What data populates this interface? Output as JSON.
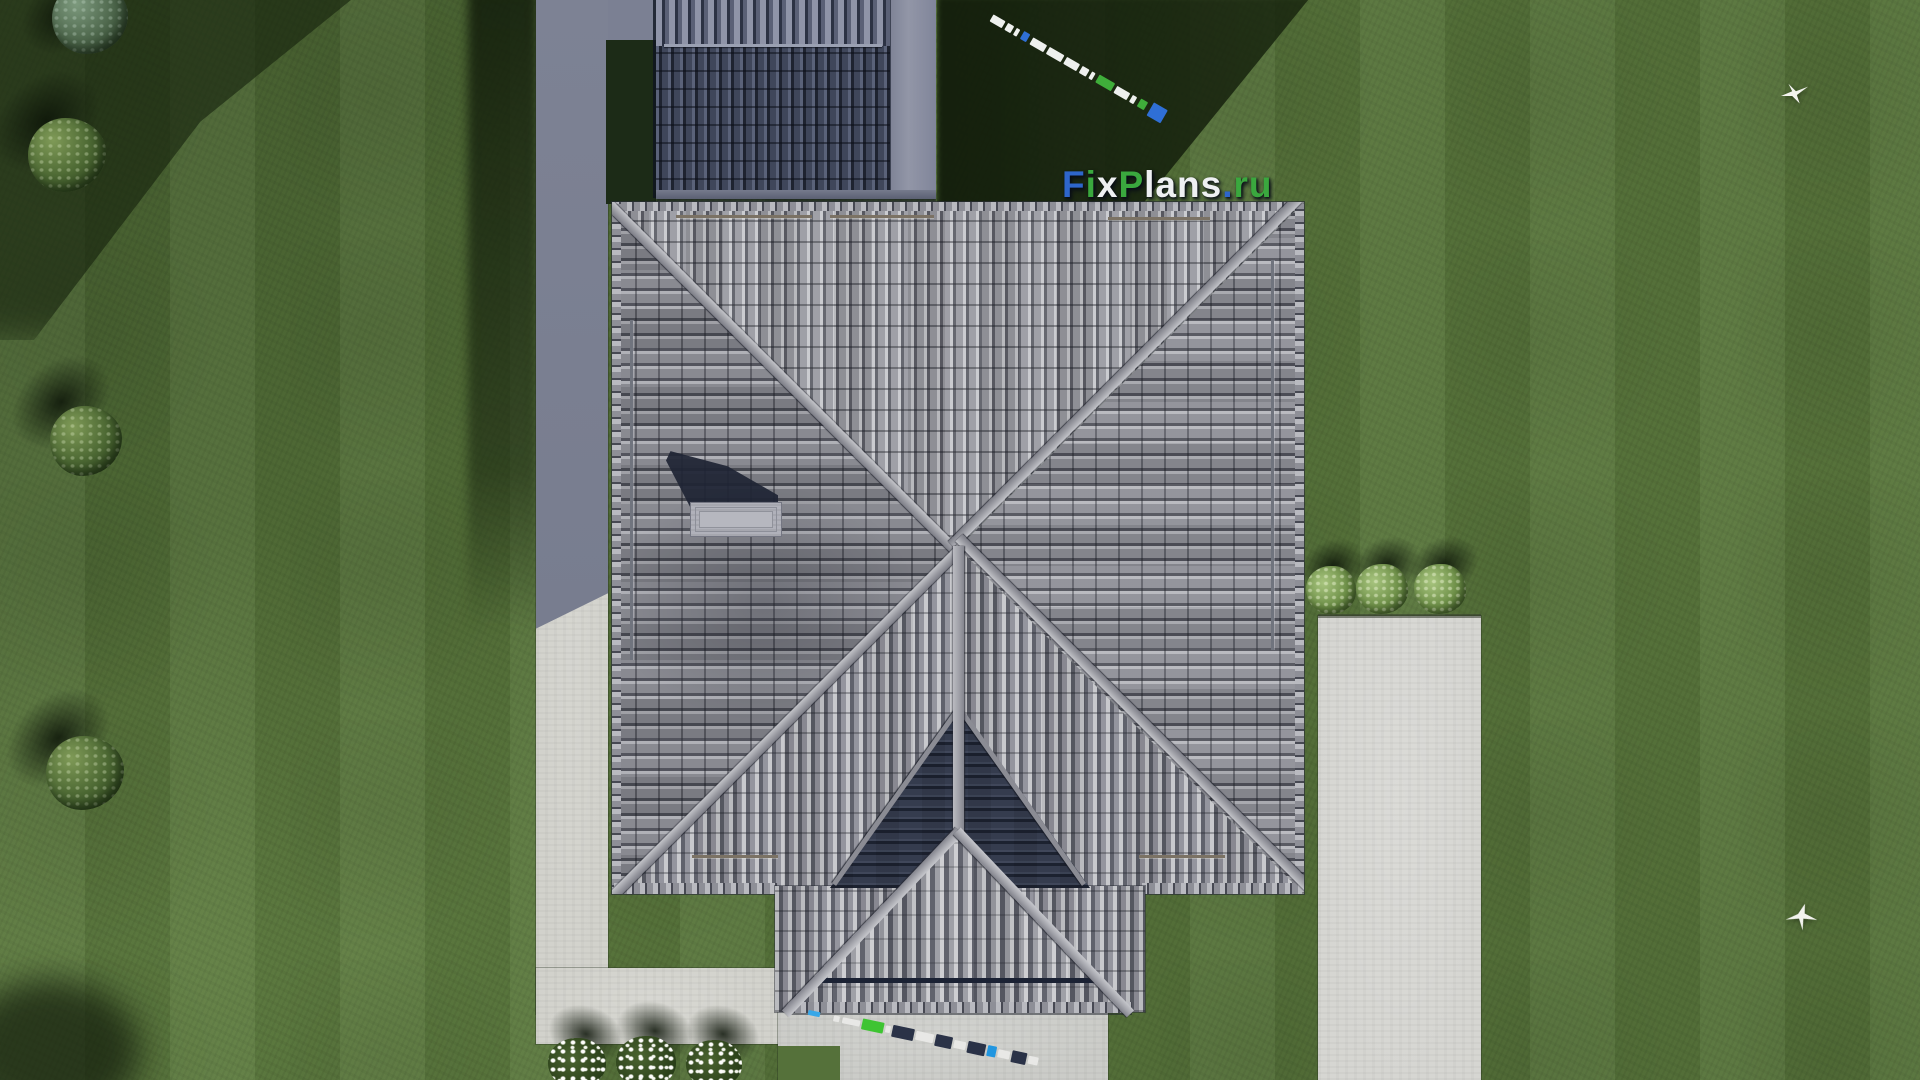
{
  "watermark": {
    "text": "FixPlans.ru",
    "segments": [
      {
        "text": "F",
        "color": "#2e66cb"
      },
      {
        "text": "i",
        "color": "#3aa83e"
      },
      {
        "text": "x",
        "color": "#eef0f2"
      },
      {
        "text": "P",
        "color": "#3aa83e"
      },
      {
        "text": "lans",
        "color": "#eef0f2"
      },
      {
        "text": ".",
        "color": "#2e66cb"
      },
      {
        "text": "ru",
        "color": "#3aa83e"
      }
    ]
  },
  "colors": {
    "grass_base": "#57743b",
    "grass_shadow": "#1c2b17",
    "concrete_light": "#d2d2cc",
    "concrete_shadow": "#7b8093",
    "roof_light_face": "#9a9ba2",
    "roof_dark_gap": "#53555f",
    "roof_ridge": "#a8a9b0",
    "annex_tile": "#3a4154",
    "pediment": "#353c4e",
    "watermark_blue": "#2e66cb",
    "watermark_green": "#3aa83e",
    "watermark_white": "#eef0f2"
  },
  "survey_tape": {
    "segments": [
      {
        "g": 0,
        "w": 14,
        "h": 8,
        "c": "#eef0ee"
      },
      {
        "g": 3,
        "w": 7,
        "h": 8,
        "c": "#eef0ee"
      },
      {
        "g": 3,
        "w": 4,
        "h": 8,
        "c": "#eef0ee"
      },
      {
        "g": 4,
        "w": 7,
        "h": 9,
        "c": "#2f6fd6"
      },
      {
        "g": 4,
        "w": 16,
        "h": 8,
        "c": "#eef0ee"
      },
      {
        "g": 3,
        "w": 17,
        "h": 8,
        "c": "#eef0ee"
      },
      {
        "g": 3,
        "w": 15,
        "h": 8,
        "c": "#eef0ee"
      },
      {
        "g": 3,
        "w": 8,
        "h": 8,
        "c": "#eef0ee"
      },
      {
        "g": 3,
        "w": 4,
        "h": 8,
        "c": "#eef0ee"
      },
      {
        "g": 4,
        "w": 18,
        "h": 9,
        "c": "#3fae3a"
      },
      {
        "g": 3,
        "w": 15,
        "h": 8,
        "c": "#eef0ee"
      },
      {
        "g": 3,
        "w": 5,
        "h": 8,
        "c": "#eef0ee"
      },
      {
        "g": 4,
        "w": 8,
        "h": 9,
        "c": "#3fae3a"
      },
      {
        "g": 5,
        "w": 16,
        "h": 15,
        "c": "#2f6fd6"
      }
    ]
  },
  "ground_marks": {
    "segments": [
      {
        "g": 0,
        "w": 12,
        "h": 5,
        "c": "#37a7e8"
      },
      {
        "g": 14,
        "w": 6,
        "h": 6,
        "c": "#e8e8e6"
      },
      {
        "g": 3,
        "w": 18,
        "h": 6,
        "c": "#e8e8e6"
      },
      {
        "g": 2,
        "w": 22,
        "h": 11,
        "c": "#3ec432"
      },
      {
        "g": 2,
        "w": 5,
        "h": 7,
        "c": "#e8e8e6"
      },
      {
        "g": 2,
        "w": 22,
        "h": 12,
        "c": "#2a3247"
      },
      {
        "g": 2,
        "w": 18,
        "h": 9,
        "c": "#e8e8e6"
      },
      {
        "g": 2,
        "w": 17,
        "h": 12,
        "c": "#2a3247"
      },
      {
        "g": 2,
        "w": 12,
        "h": 8,
        "c": "#e8e8e6"
      },
      {
        "g": 2,
        "w": 18,
        "h": 12,
        "c": "#2a3247"
      },
      {
        "g": 2,
        "w": 9,
        "h": 11,
        "c": "#2196e0"
      },
      {
        "g": 2,
        "w": 12,
        "h": 8,
        "c": "#e8e8e6"
      },
      {
        "g": 2,
        "w": 15,
        "h": 12,
        "c": "#2a3247"
      },
      {
        "g": 2,
        "w": 10,
        "h": 8,
        "c": "#e8e8e6"
      }
    ]
  }
}
